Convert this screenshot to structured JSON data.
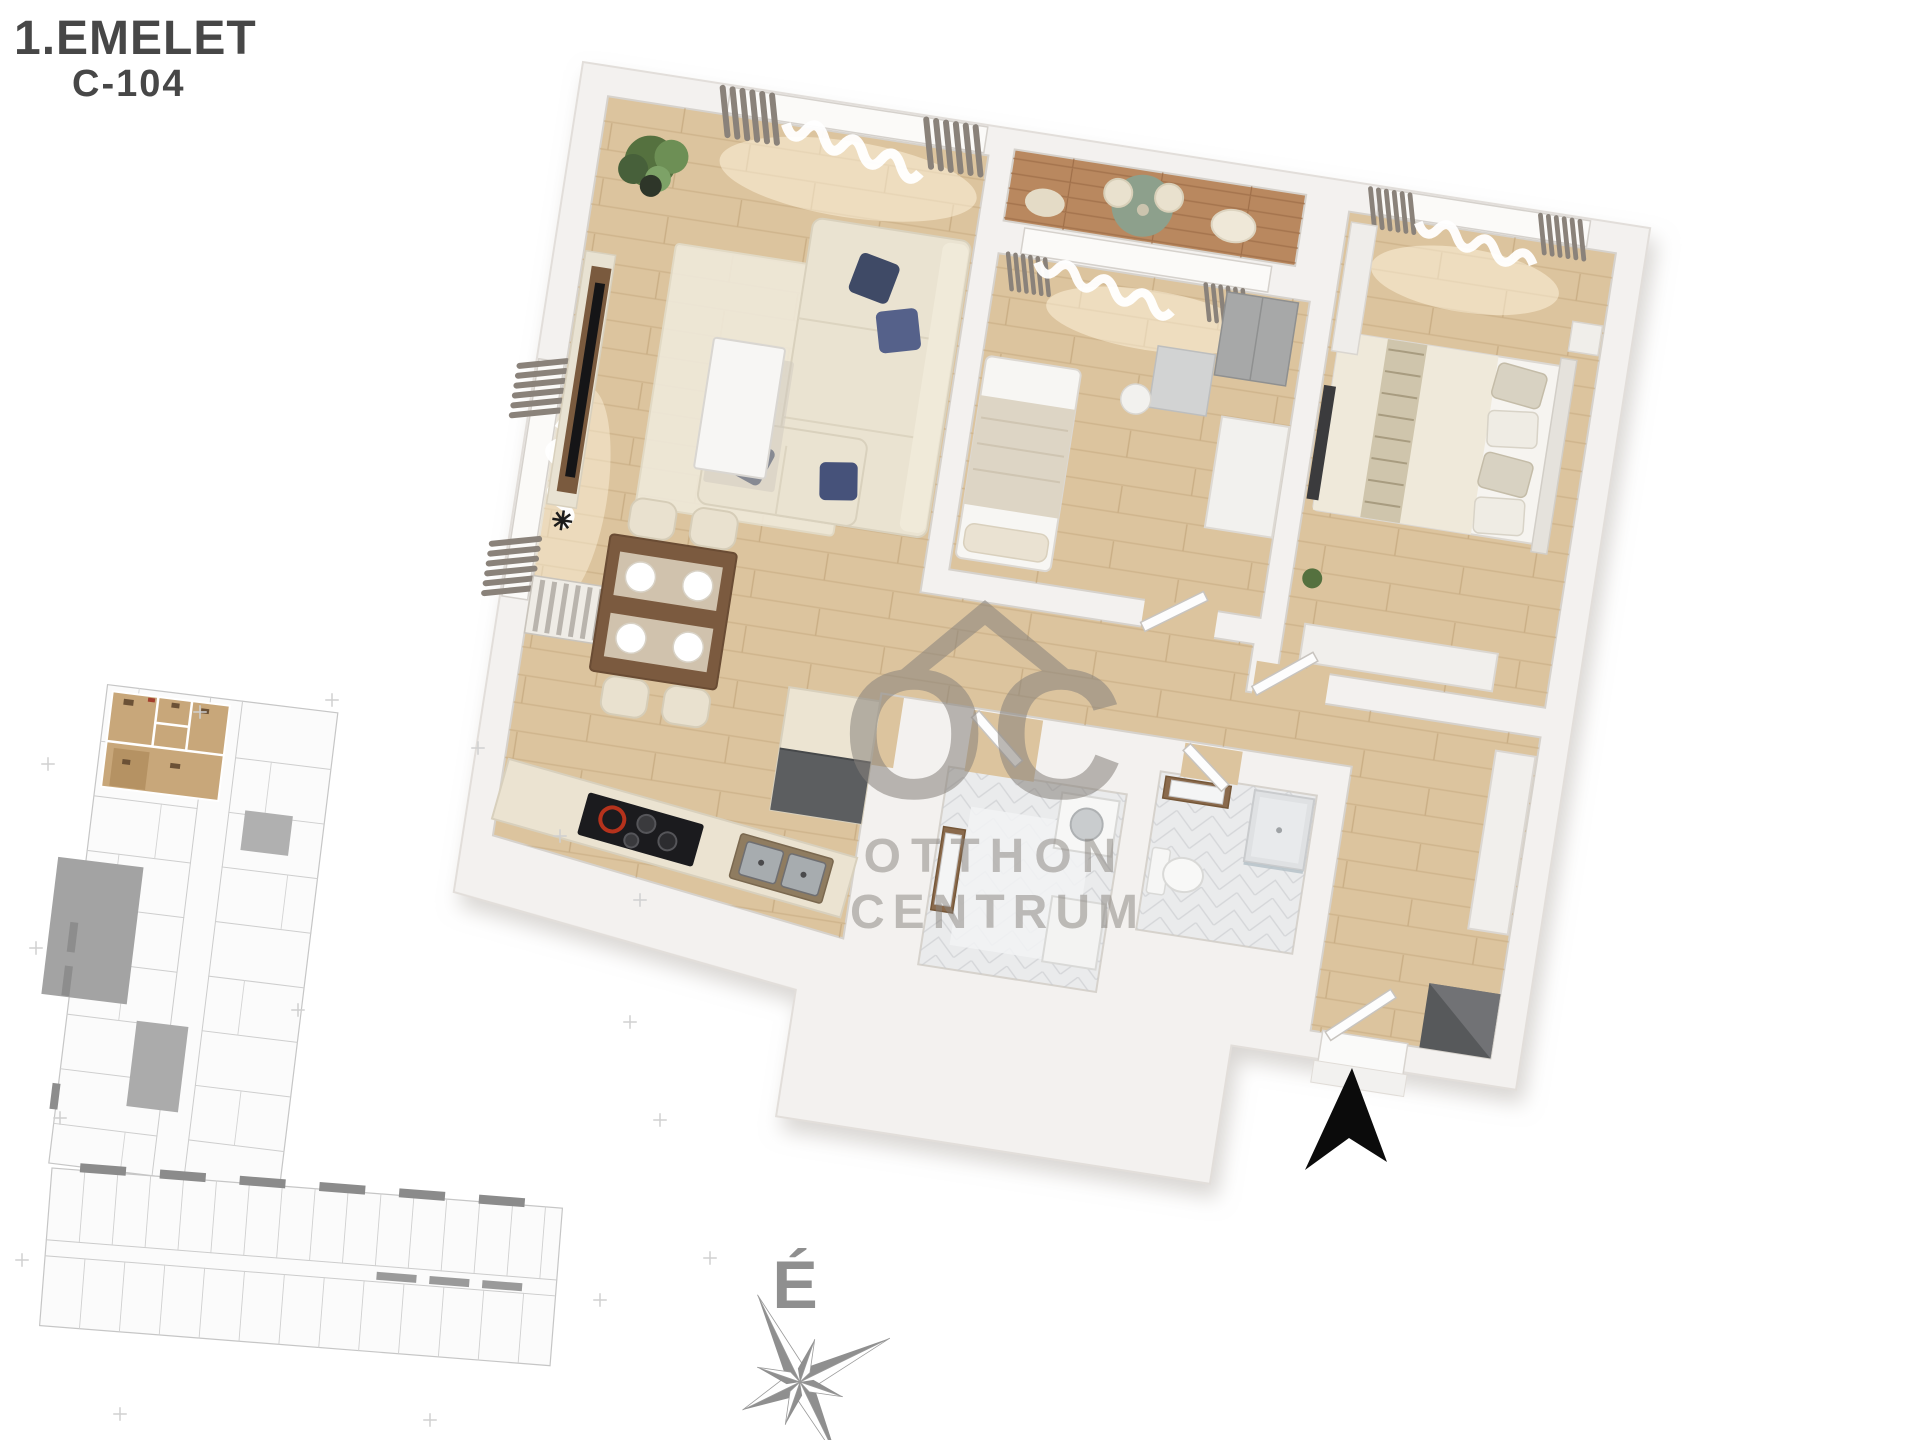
{
  "header": {
    "floor_label": "1.EMELET",
    "unit_label": "C-104"
  },
  "watermark": {
    "logo_text": "OC",
    "brand_line1": "OTTHON",
    "brand_line2": "CENTRUM"
  },
  "compass": {
    "north_label": "É"
  },
  "colors": {
    "title_text": "#474747",
    "wall": "#f3f1ef",
    "wood_floor": "#dcc49e",
    "balcony_deck": "#b9885f",
    "bathroom_tile": "#eaebec",
    "watermark_gray": "#87827c",
    "compass_gray": "#8f8f8f",
    "entrance_arrow": "#0b0b0b",
    "highlight_unit_tan": "#c8a77a",
    "navy_pillow": "#3f4a66",
    "cooktop_red": "#b5321c",
    "dining_table_wood": "#7b5a3f"
  }
}
